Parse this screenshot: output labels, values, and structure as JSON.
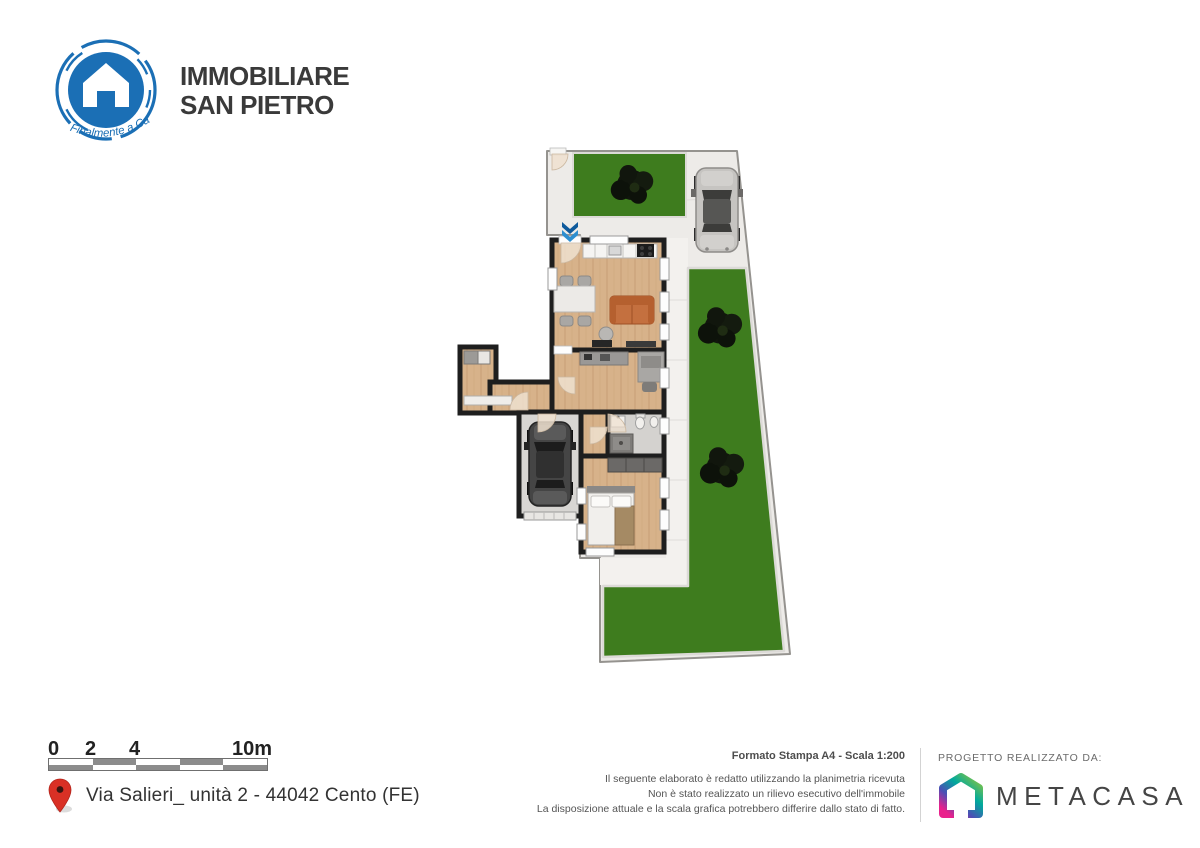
{
  "header": {
    "brand_line1": "IMMOBILIARE",
    "brand_line2": "SAN PIETRO",
    "brand_tagline": "Finalmente a Casa"
  },
  "footer": {
    "scale_bar": {
      "ticks": [
        "0",
        "2",
        "4",
        "10m"
      ]
    },
    "address": "Via Salieri_ unità 2 - 44042 Cento (FE)",
    "print_format": "Formato Stampa A4 - Scala 1:200",
    "disclaimer_lines": [
      "Il seguente elaborato è redatto utilizzando la planimetria ricevuta",
      "Non è stato realizzato un rilievo esecutivo dell'immobile",
      "La disposizione attuale e la scala grafica potrebbero differire dallo stato di fatto."
    ],
    "credits_label": "PROGETTO REALIZZATO DA:",
    "credits_company": "METACASA"
  },
  "icons": {
    "brand_logo": "house-in-circle",
    "entrance_marker": "double-chevron-down",
    "address_pin": "map-pin",
    "credits_logo": "gradient-house",
    "trees": "dark-shrub-top-view",
    "cars": "car-top-view"
  },
  "colors": {
    "brand_blue": "#1b6fb5",
    "entrance_arrow_blue": "#2e8fd0",
    "grass_green": "#3e7c1e",
    "wall_black": "#1e1e1e",
    "wood_floor": "#d7b28a",
    "paving_gray": "#edebe8",
    "sofa_orange": "#c4703f",
    "pin_red": "#d93025",
    "metacasa_gradient": [
      "#8cc63f",
      "#00a99d",
      "#e9218c"
    ]
  }
}
